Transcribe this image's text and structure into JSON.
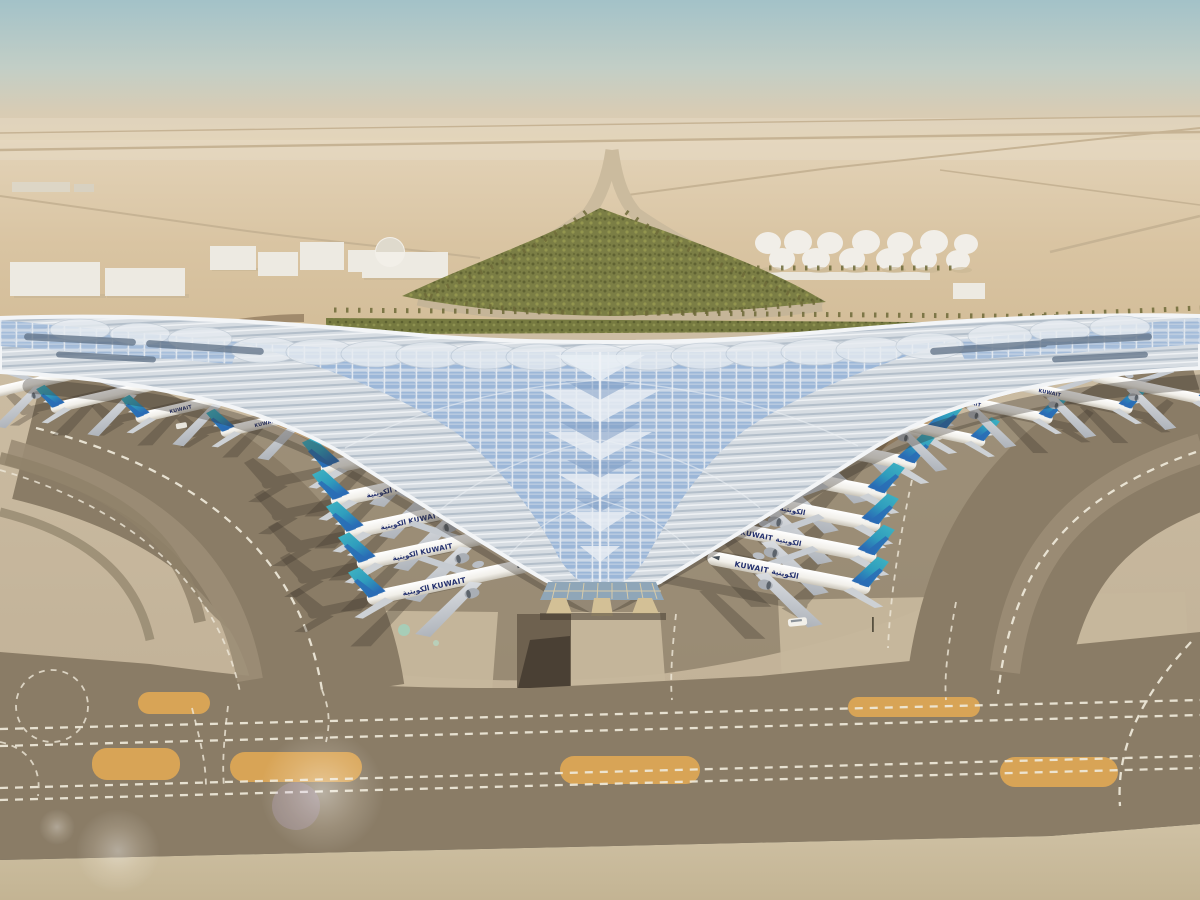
{
  "scene": {
    "airline": {
      "name_en": "KUWAIT",
      "name_ar": "الكويتية",
      "label_left": "الكويتية KUWAIT",
      "label_right": "KUWAIT الكويتية"
    },
    "aircraft_counts": {
      "left_gate_row": 5,
      "right_gate_row": 6,
      "left_pier": 4,
      "right_pier": 4
    },
    "colors": {
      "sky_top": "#a3c2c8",
      "sky_haze": "#ddccb2",
      "desert": "#dcc5a2",
      "roof_silver": "#d6dce2",
      "solar_panel_blue": "#9cb7d8",
      "roof_white": "#f3f5f7",
      "hedge_green": "#76793f",
      "apron": "#c7b89e",
      "terminal_shadow": "#84775f",
      "taxiway": "#8a7c66",
      "marking_white": "#efe9da",
      "island_orange": "#d8a456",
      "gate_facade_tan": "#bb9b73",
      "tail_teal": "#3aa9bc",
      "tail_blue": "#2a6cb5",
      "titles_navy": "#23306e",
      "fuselage_white": "#f6f4ef"
    }
  }
}
